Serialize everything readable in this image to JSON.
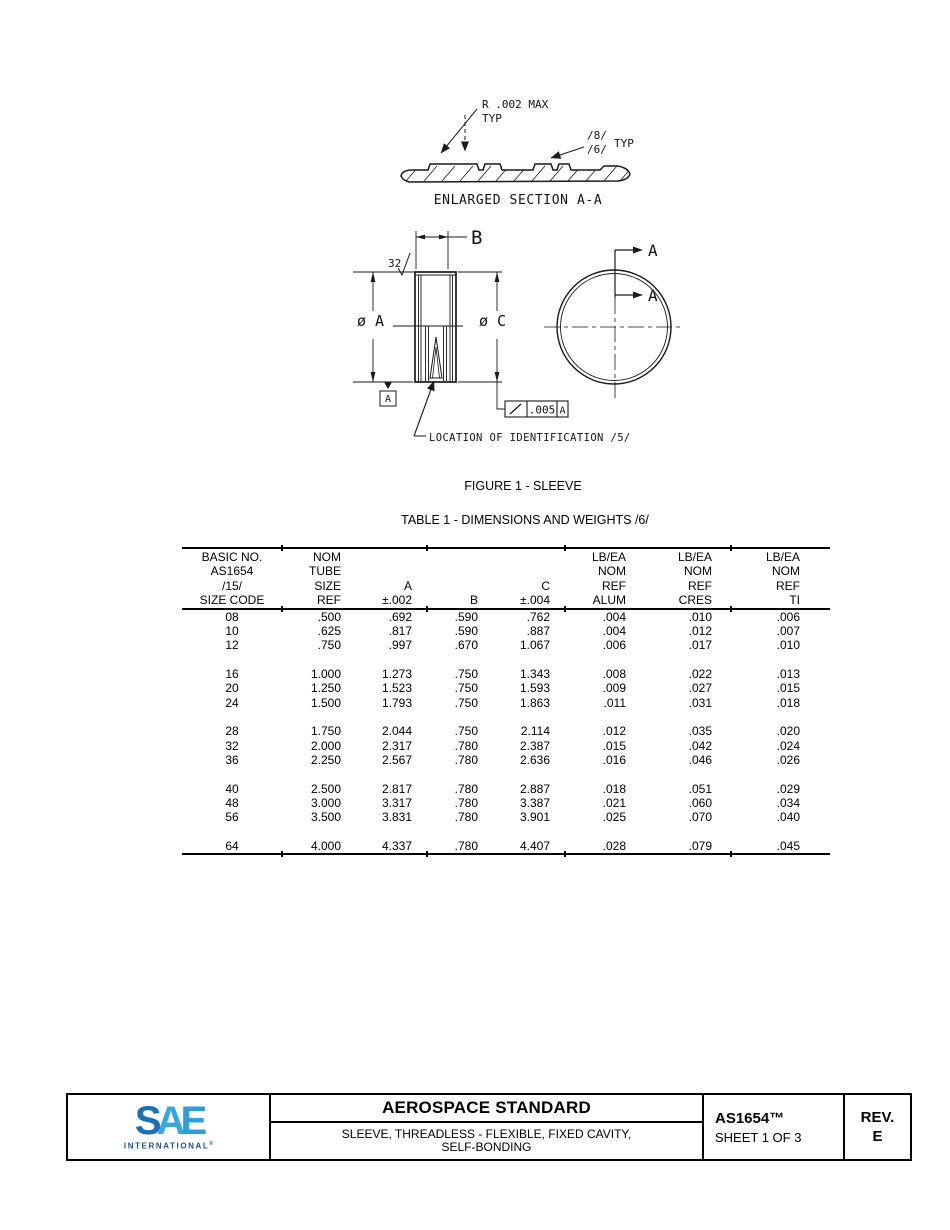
{
  "captions": {
    "figure": "FIGURE 1 - SLEEVE",
    "table": "TABLE 1 - DIMENSIONS AND WEIGHTS /6/"
  },
  "drawing": {
    "enlarged_section": {
      "radius_note_line1": "R .002 MAX",
      "radius_note_line2": "TYP",
      "finish_flag_top": "/8/",
      "finish_flag_bottom": "/6/",
      "finish_typ": "TYP",
      "caption": "ENLARGED SECTION A-A"
    },
    "side_view": {
      "surface_finish": "32",
      "width_dim": "B",
      "left_diameter": "ø A",
      "right_diameter": "ø C",
      "datum_label": "A",
      "runout_value": ".005",
      "runout_datum": "A",
      "id_note": "LOCATION OF IDENTIFICATION /5/"
    },
    "end_view": {
      "cut_label_top": "A",
      "cut_label_bottom": "A"
    }
  },
  "table": {
    "columns": [
      {
        "lines": [
          "BASIC NO.",
          "AS1654",
          "/15/",
          "SIZE CODE"
        ]
      },
      {
        "lines": [
          "NOM",
          "TUBE",
          "SIZE",
          "REF"
        ]
      },
      {
        "lines": [
          "",
          "",
          "A",
          "±.002"
        ]
      },
      {
        "lines": [
          "",
          "",
          "",
          "B"
        ]
      },
      {
        "lines": [
          "",
          "",
          "C",
          "±.004"
        ]
      },
      {
        "lines": [
          "LB/EA",
          "NOM",
          "REF",
          "ALUM"
        ]
      },
      {
        "lines": [
          "LB/EA",
          "NOM",
          "REF",
          "CRES"
        ]
      },
      {
        "lines": [
          "LB/EA",
          "NOM",
          "REF",
          "TI"
        ]
      }
    ],
    "groups": [
      [
        [
          "08",
          ".500",
          ".692",
          ".590",
          ".762",
          ".004",
          ".010",
          ".006"
        ],
        [
          "10",
          ".625",
          ".817",
          ".590",
          ".887",
          ".004",
          ".012",
          ".007"
        ],
        [
          "12",
          ".750",
          ".997",
          ".670",
          "1.067",
          ".006",
          ".017",
          ".010"
        ]
      ],
      [
        [
          "16",
          "1.000",
          "1.273",
          ".750",
          "1.343",
          ".008",
          ".022",
          ".013"
        ],
        [
          "20",
          "1.250",
          "1.523",
          ".750",
          "1.593",
          ".009",
          ".027",
          ".015"
        ],
        [
          "24",
          "1.500",
          "1.793",
          ".750",
          "1.863",
          ".011",
          ".031",
          ".018"
        ]
      ],
      [
        [
          "28",
          "1.750",
          "2.044",
          ".750",
          "2.114",
          ".012",
          ".035",
          ".020"
        ],
        [
          "32",
          "2.000",
          "2.317",
          ".780",
          "2.387",
          ".015",
          ".042",
          ".024"
        ],
        [
          "36",
          "2.250",
          "2.567",
          ".780",
          "2.636",
          ".016",
          ".046",
          ".026"
        ]
      ],
      [
        [
          "40",
          "2.500",
          "2.817",
          ".780",
          "2.887",
          ".018",
          ".051",
          ".029"
        ],
        [
          "48",
          "3.000",
          "3.317",
          ".780",
          "3.387",
          ".021",
          ".060",
          ".034"
        ],
        [
          "56",
          "3.500",
          "3.831",
          ".780",
          "3.901",
          ".025",
          ".070",
          ".040"
        ]
      ],
      [
        [
          "64",
          "4.000",
          "4.337",
          ".780",
          "4.407",
          ".028",
          ".079",
          ".045"
        ]
      ]
    ]
  },
  "footer": {
    "logo": {
      "letter_s": "S",
      "letter_a": "A",
      "letter_e": "E",
      "tagline": "INTERNATIONAL",
      "reg": "®"
    },
    "title": "AEROSPACE STANDARD",
    "subtitle_line1": "SLEEVE, THREADLESS - FLEXIBLE, FIXED CAVITY,",
    "subtitle_line2": "SELF-BONDING",
    "doc_number": "AS1654™",
    "sheet": "SHEET 1 OF 3",
    "rev_label": "REV.",
    "rev_value": "E"
  },
  "colors": {
    "line_color": "#1a1a1a",
    "sae_blue_dark": "#1b6fb5",
    "sae_blue_light": "#35a8e0",
    "sae_navy": "#1a5287"
  }
}
